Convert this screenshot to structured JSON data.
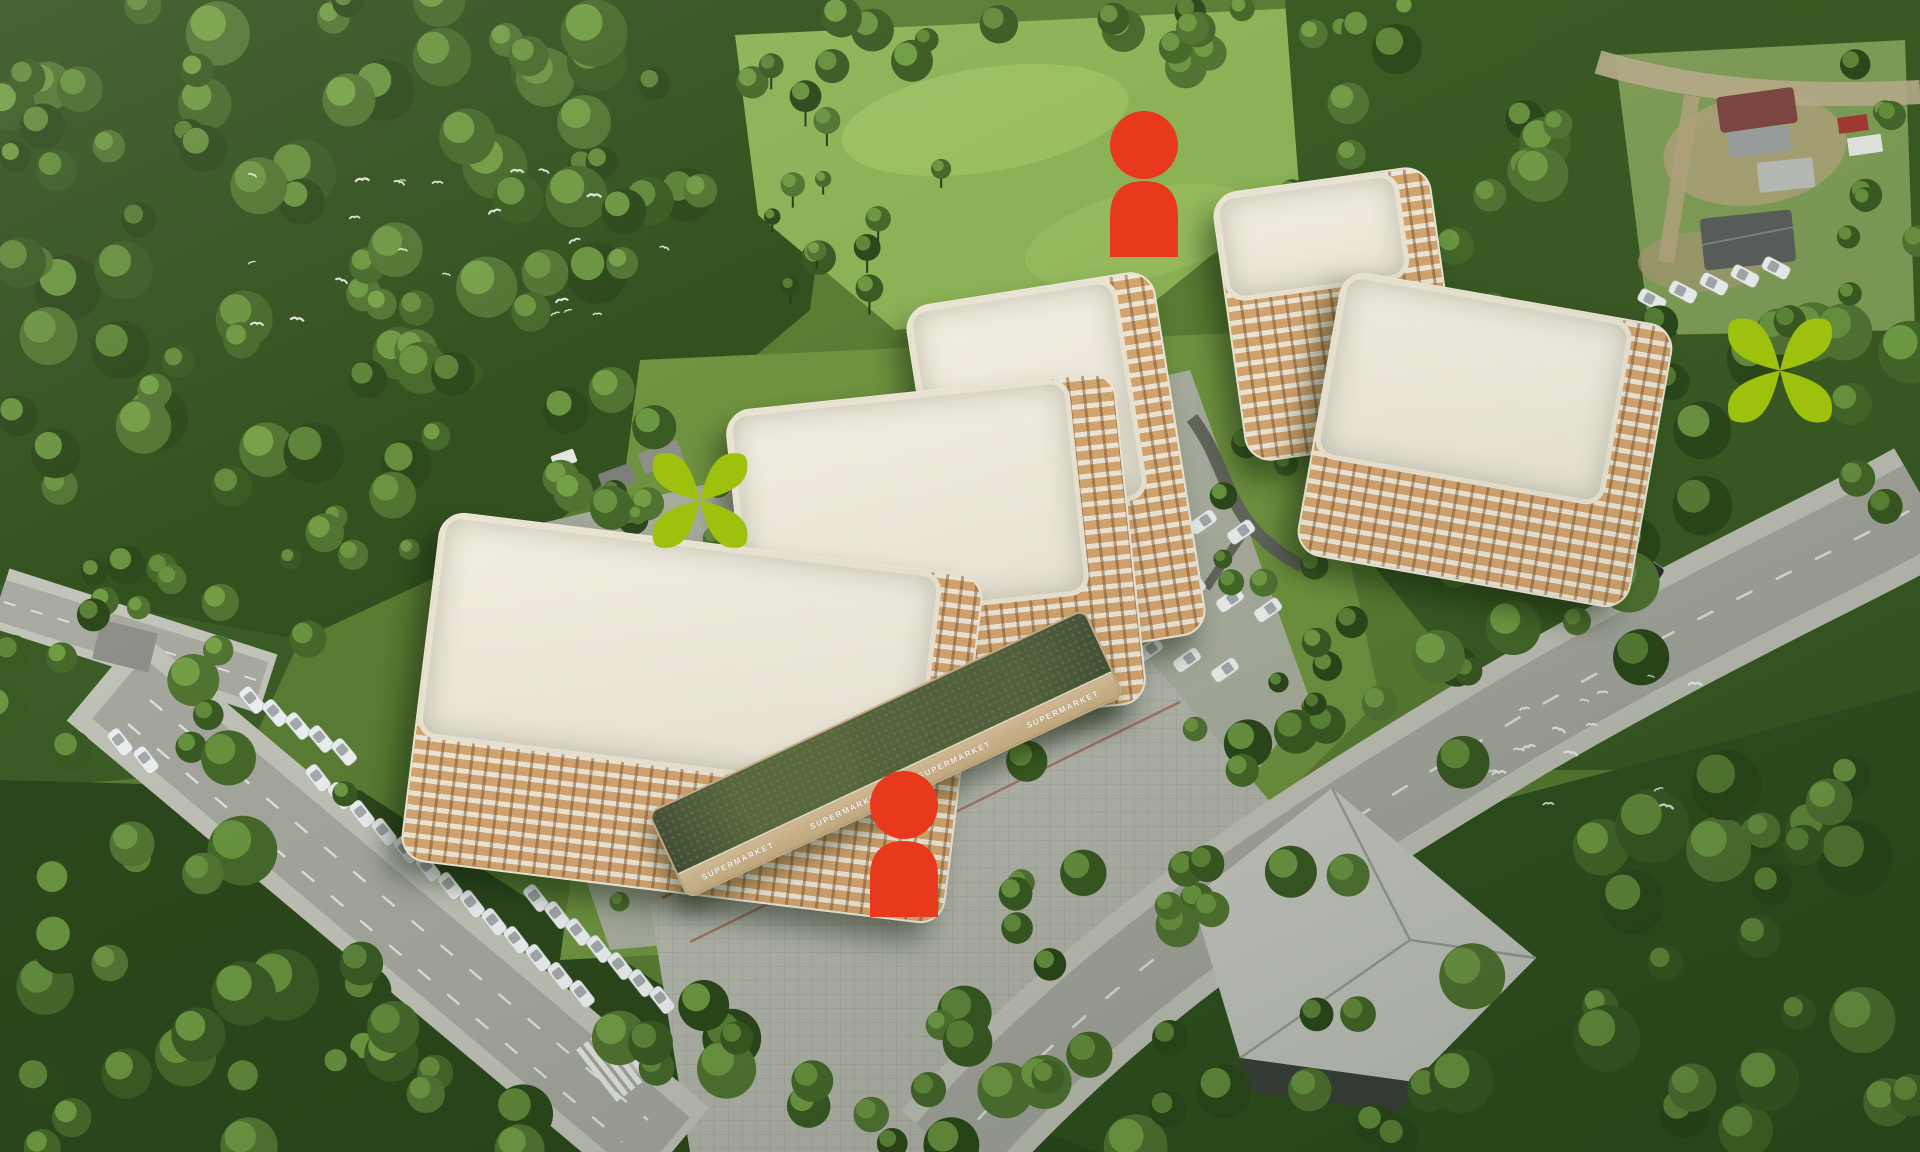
{
  "scene": {
    "supermarket": {
      "sign_label": "SUPERMARKET",
      "sign_count": 4
    },
    "colors": {
      "marker_red": "#e8391d",
      "marker_green": "#9ec10d",
      "facade_cream": "#efe8d8",
      "facade_tan": "#d5a671",
      "roof_gray": "#a0a28c",
      "retail_roof_green": "#47523a",
      "forest_dark": "#33511f",
      "meadow_green": "#8cb257",
      "road_gray": "#a5a79e",
      "sidewalk_gray": "#c0c1b7",
      "plaza_pavers": "#b3b5ab",
      "car_white": "#edf0f0"
    },
    "buildings": [
      {
        "id": "building-north-tower",
        "type": "residential",
        "floors": 9,
        "x": 1228,
        "y": 178,
        "w": 220,
        "h": 272,
        "angle": -8,
        "dr": 30,
        "db": 160
      },
      {
        "id": "building-center-rear",
        "type": "residential",
        "floors": 8,
        "x": 930,
        "y": 286,
        "w": 252,
        "h": 368,
        "angle": -9,
        "dr": 36,
        "db": 140
      },
      {
        "id": "building-east",
        "type": "residential",
        "floors": 8,
        "x": 1316,
        "y": 296,
        "w": 338,
        "h": 288,
        "angle": 10,
        "dr": 40,
        "db": 96
      },
      {
        "id": "building-center",
        "type": "residential",
        "floors": 8,
        "x": 740,
        "y": 390,
        "w": 392,
        "h": 334,
        "angle": -6,
        "dr": 44,
        "db": 112
      },
      {
        "id": "building-southwest",
        "type": "residential",
        "floors": 8,
        "x": 418,
        "y": 542,
        "w": 548,
        "h": 352,
        "angle": 7,
        "dr": 40,
        "db": 122
      },
      {
        "id": "supermarket-strip",
        "type": "retail",
        "floors": 1,
        "x": 645,
        "y": 706,
        "w": 482,
        "h": 96,
        "angle": -25
      }
    ],
    "markers": [
      {
        "id": "person-marker-north",
        "type": "person",
        "color": "#e8391d",
        "x": 1144,
        "y": 111,
        "w": 72,
        "h": 146
      },
      {
        "id": "person-marker-south",
        "type": "person",
        "color": "#e8391d",
        "x": 904,
        "y": 771,
        "w": 72,
        "h": 146
      },
      {
        "id": "flower-marker-west",
        "type": "flower",
        "color": "#9ec10d",
        "x": 700,
        "y": 449,
        "w": 103,
        "h": 103
      },
      {
        "id": "flower-marker-east",
        "type": "flower",
        "color": "#9ec10d",
        "x": 1780,
        "y": 314,
        "w": 113,
        "h": 113
      }
    ]
  }
}
